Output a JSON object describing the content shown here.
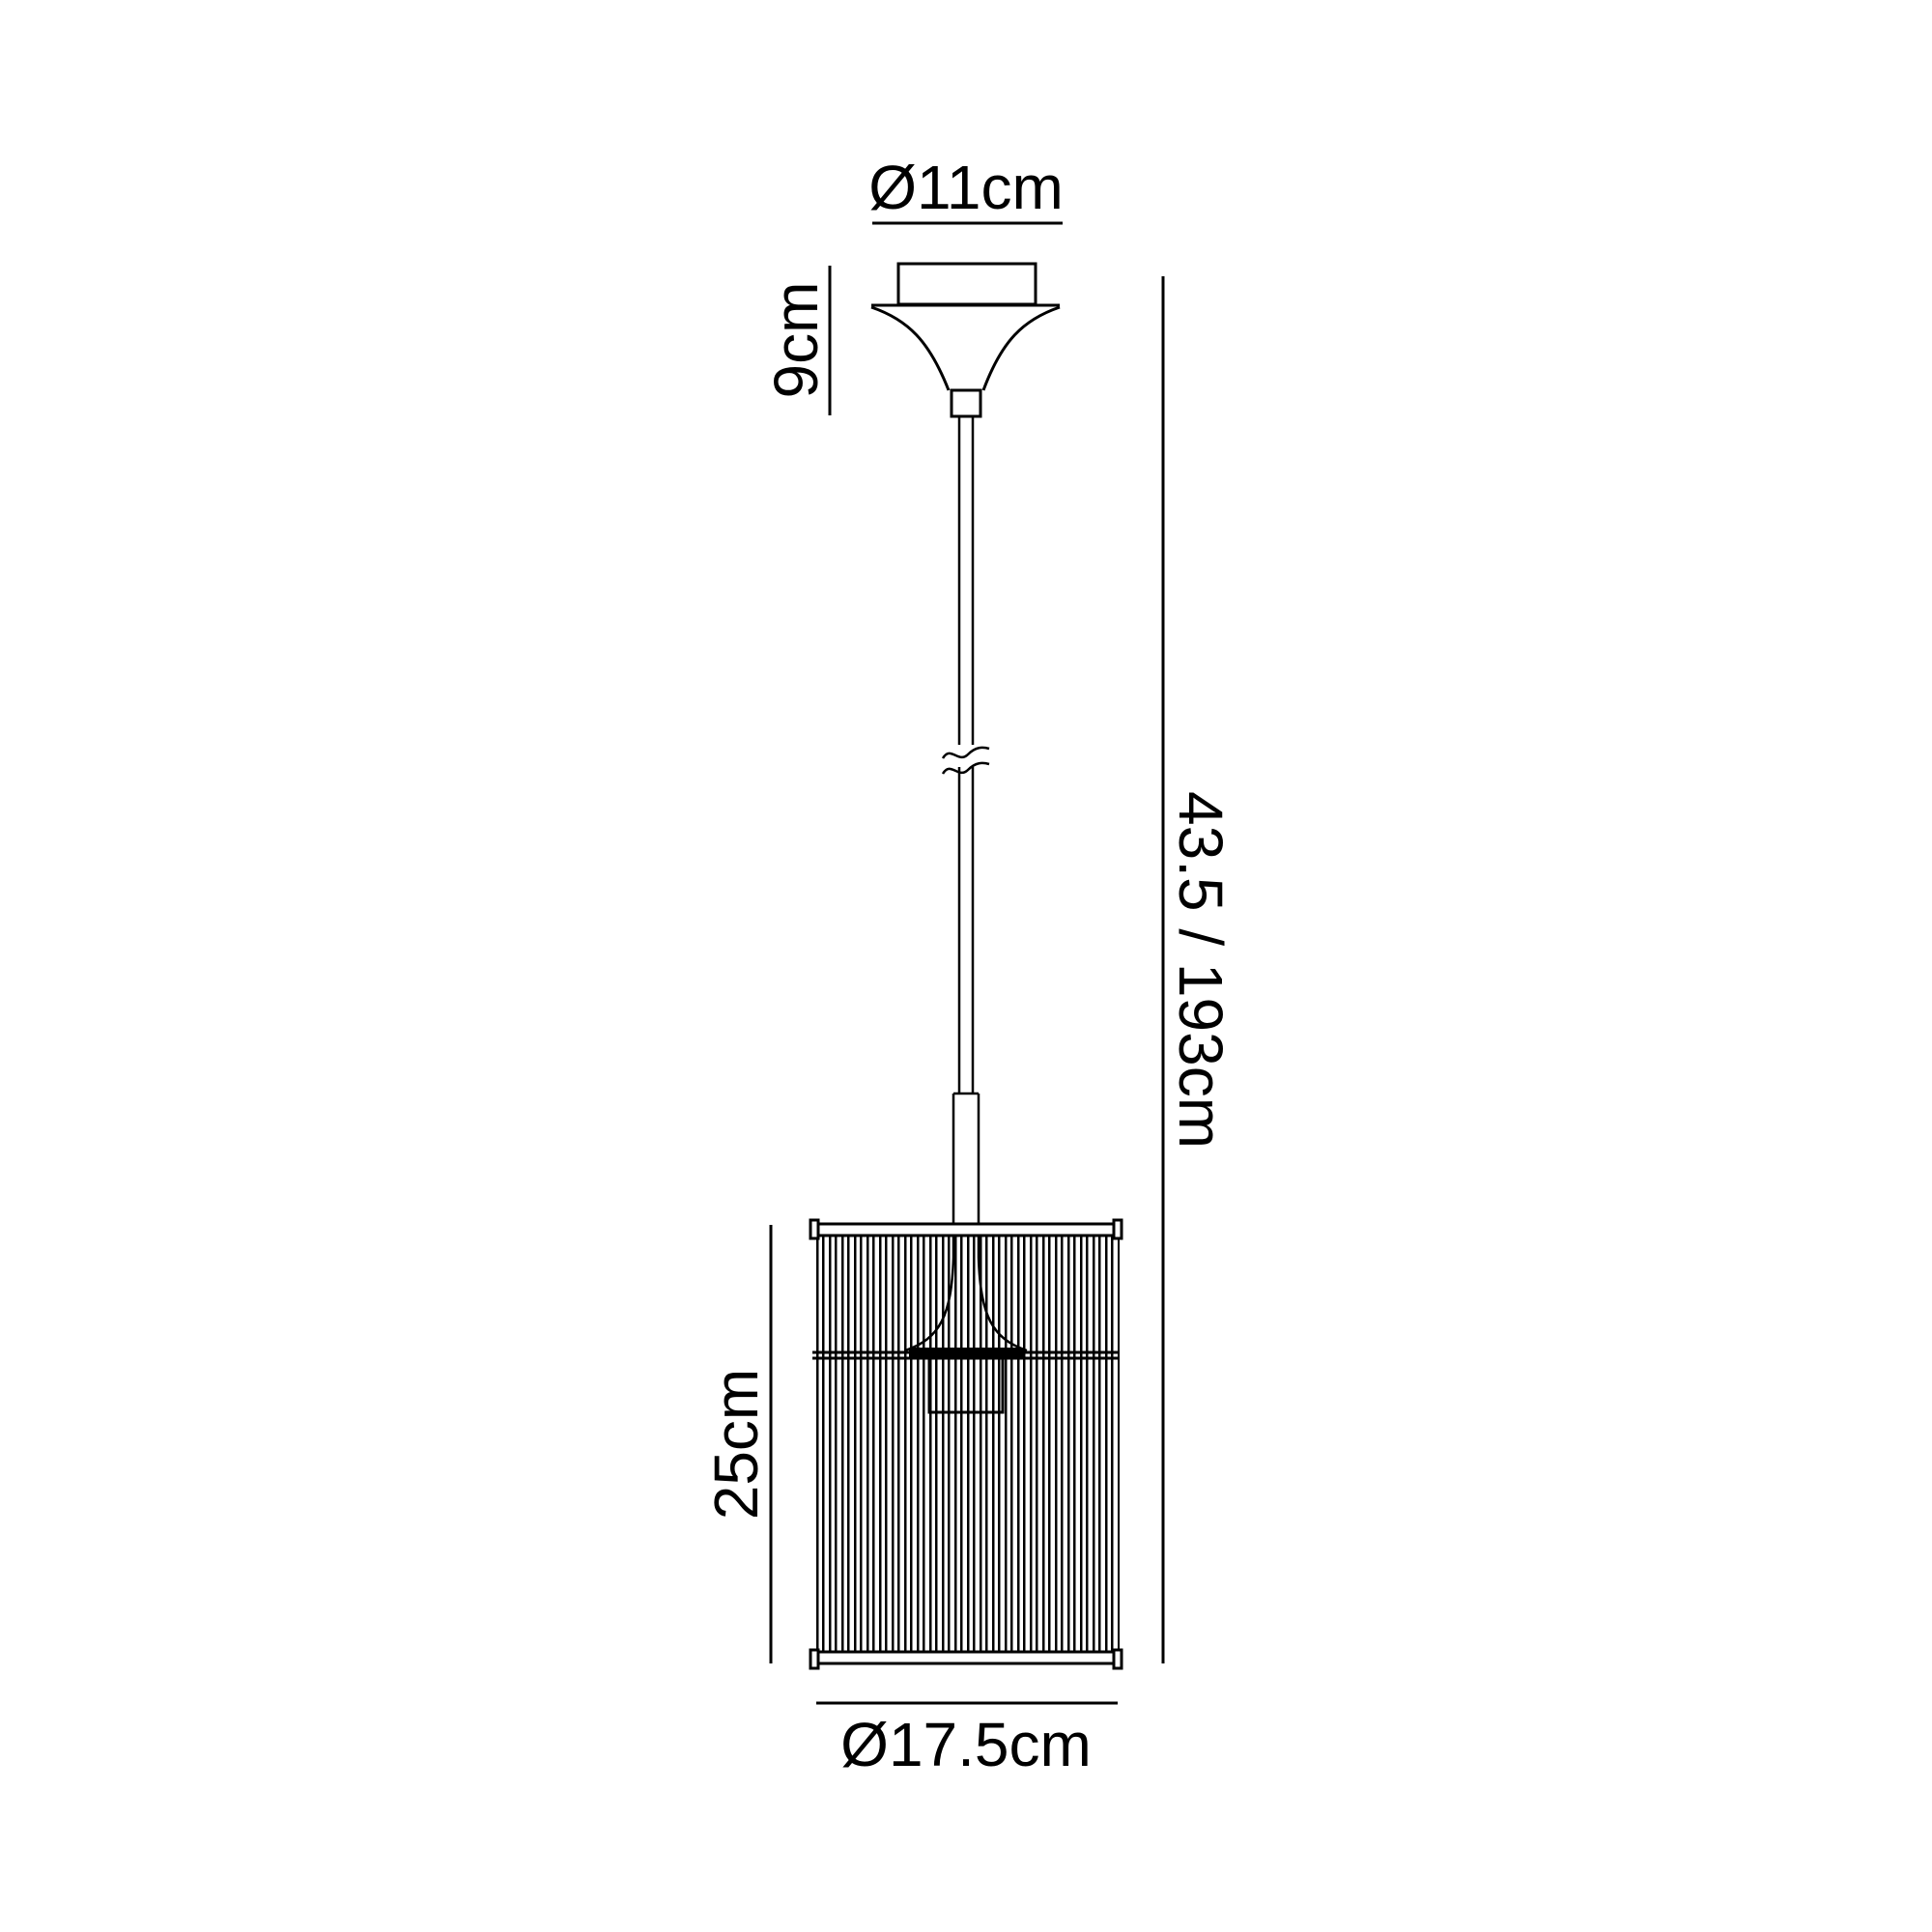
{
  "diagram": {
    "type": "product-dimension-diagram",
    "subject": "pendant ceiling light line drawing",
    "background_color": "#ffffff",
    "line_color": "#000000",
    "dimensions": {
      "canopy_diameter": "Ø11cm",
      "canopy_height": "9cm",
      "total_drop": "43.5 / 193cm",
      "shade_height": "25cm",
      "shade_diameter": "Ø17.5cm"
    }
  }
}
